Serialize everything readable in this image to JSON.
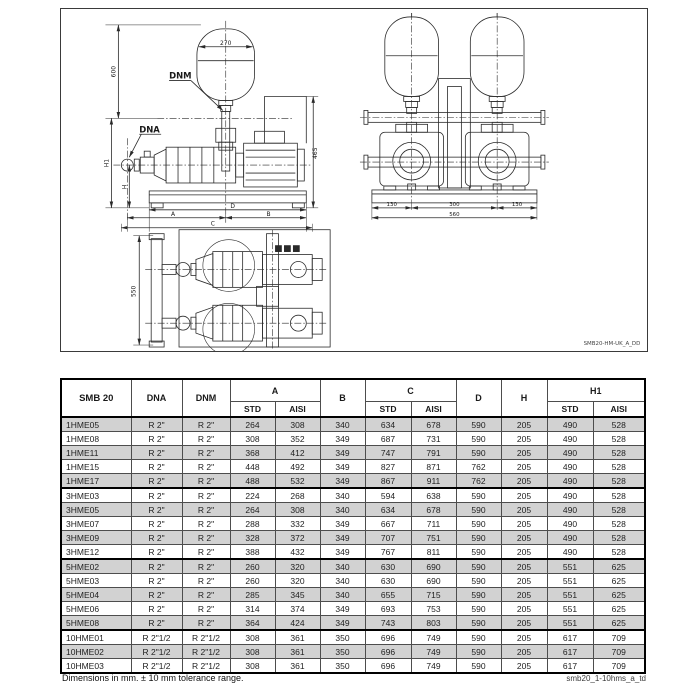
{
  "drawing": {
    "code": "SMB20-HM-UK_A_DD",
    "labels": {
      "tank_diameter": "270",
      "overall_height": "600",
      "dnm": "DNM",
      "dna": "DNA",
      "h1": "H1",
      "h": "H",
      "motor_height": "465",
      "dim_d": "D",
      "dim_a": "A",
      "dim_b": "B",
      "dim_c": "C",
      "front_left": "130",
      "front_mid": "300",
      "front_right": "130",
      "front_total": "560",
      "plan_depth": "550"
    }
  },
  "table": {
    "title": "SMB 20",
    "col_dna": "DNA",
    "col_dnm": "DNM",
    "col_a": "A",
    "col_b": "B",
    "col_c": "C",
    "col_d": "D",
    "col_h": "H",
    "col_h1": "H1",
    "sub_std": "STD",
    "sub_aisi": "AISI",
    "rows": [
      {
        "model": "1HME05",
        "dna": "R 2\"",
        "dnm": "R 2\"",
        "a_std": "264",
        "a_aisi": "308",
        "b": "340",
        "c_std": "634",
        "c_aisi": "678",
        "d": "590",
        "h": "205",
        "h1_std": "490",
        "h1_aisi": "528",
        "group_start": false
      },
      {
        "model": "1HME08",
        "dna": "R 2\"",
        "dnm": "R 2\"",
        "a_std": "308",
        "a_aisi": "352",
        "b": "349",
        "c_std": "687",
        "c_aisi": "731",
        "d": "590",
        "h": "205",
        "h1_std": "490",
        "h1_aisi": "528",
        "group_start": false
      },
      {
        "model": "1HME11",
        "dna": "R 2\"",
        "dnm": "R 2\"",
        "a_std": "368",
        "a_aisi": "412",
        "b": "349",
        "c_std": "747",
        "c_aisi": "791",
        "d": "590",
        "h": "205",
        "h1_std": "490",
        "h1_aisi": "528",
        "group_start": false
      },
      {
        "model": "1HME15",
        "dna": "R 2\"",
        "dnm": "R 2\"",
        "a_std": "448",
        "a_aisi": "492",
        "b": "349",
        "c_std": "827",
        "c_aisi": "871",
        "d": "762",
        "h": "205",
        "h1_std": "490",
        "h1_aisi": "528",
        "group_start": false
      },
      {
        "model": "1HME17",
        "dna": "R 2\"",
        "dnm": "R 2\"",
        "a_std": "488",
        "a_aisi": "532",
        "b": "349",
        "c_std": "867",
        "c_aisi": "911",
        "d": "762",
        "h": "205",
        "h1_std": "490",
        "h1_aisi": "528",
        "group_start": false
      },
      {
        "model": "3HME03",
        "dna": "R 2\"",
        "dnm": "R 2\"",
        "a_std": "224",
        "a_aisi": "268",
        "b": "340",
        "c_std": "594",
        "c_aisi": "638",
        "d": "590",
        "h": "205",
        "h1_std": "490",
        "h1_aisi": "528",
        "group_start": true
      },
      {
        "model": "3HME05",
        "dna": "R 2\"",
        "dnm": "R 2\"",
        "a_std": "264",
        "a_aisi": "308",
        "b": "340",
        "c_std": "634",
        "c_aisi": "678",
        "d": "590",
        "h": "205",
        "h1_std": "490",
        "h1_aisi": "528",
        "group_start": false
      },
      {
        "model": "3HME07",
        "dna": "R 2\"",
        "dnm": "R 2\"",
        "a_std": "288",
        "a_aisi": "332",
        "b": "349",
        "c_std": "667",
        "c_aisi": "711",
        "d": "590",
        "h": "205",
        "h1_std": "490",
        "h1_aisi": "528",
        "group_start": false
      },
      {
        "model": "3HME09",
        "dna": "R 2\"",
        "dnm": "R 2\"",
        "a_std": "328",
        "a_aisi": "372",
        "b": "349",
        "c_std": "707",
        "c_aisi": "751",
        "d": "590",
        "h": "205",
        "h1_std": "490",
        "h1_aisi": "528",
        "group_start": false
      },
      {
        "model": "3HME12",
        "dna": "R 2\"",
        "dnm": "R 2\"",
        "a_std": "388",
        "a_aisi": "432",
        "b": "349",
        "c_std": "767",
        "c_aisi": "811",
        "d": "590",
        "h": "205",
        "h1_std": "490",
        "h1_aisi": "528",
        "group_start": false
      },
      {
        "model": "5HME02",
        "dna": "R 2\"",
        "dnm": "R 2\"",
        "a_std": "260",
        "a_aisi": "320",
        "b": "340",
        "c_std": "630",
        "c_aisi": "690",
        "d": "590",
        "h": "205",
        "h1_std": "551",
        "h1_aisi": "625",
        "group_start": true
      },
      {
        "model": "5HME03",
        "dna": "R 2\"",
        "dnm": "R 2\"",
        "a_std": "260",
        "a_aisi": "320",
        "b": "340",
        "c_std": "630",
        "c_aisi": "690",
        "d": "590",
        "h": "205",
        "h1_std": "551",
        "h1_aisi": "625",
        "group_start": false
      },
      {
        "model": "5HME04",
        "dna": "R 2\"",
        "dnm": "R 2\"",
        "a_std": "285",
        "a_aisi": "345",
        "b": "340",
        "c_std": "655",
        "c_aisi": "715",
        "d": "590",
        "h": "205",
        "h1_std": "551",
        "h1_aisi": "625",
        "group_start": false
      },
      {
        "model": "5HME06",
        "dna": "R 2\"",
        "dnm": "R 2\"",
        "a_std": "314",
        "a_aisi": "374",
        "b": "349",
        "c_std": "693",
        "c_aisi": "753",
        "d": "590",
        "h": "205",
        "h1_std": "551",
        "h1_aisi": "625",
        "group_start": false
      },
      {
        "model": "5HME08",
        "dna": "R 2\"",
        "dnm": "R 2\"",
        "a_std": "364",
        "a_aisi": "424",
        "b": "349",
        "c_std": "743",
        "c_aisi": "803",
        "d": "590",
        "h": "205",
        "h1_std": "551",
        "h1_aisi": "625",
        "group_start": false
      },
      {
        "model": "10HME01",
        "dna": "R 2\"1/2",
        "dnm": "R 2\"1/2",
        "a_std": "308",
        "a_aisi": "361",
        "b": "350",
        "c_std": "696",
        "c_aisi": "749",
        "d": "590",
        "h": "205",
        "h1_std": "617",
        "h1_aisi": "709",
        "group_start": true
      },
      {
        "model": "10HME02",
        "dna": "R 2\"1/2",
        "dnm": "R 2\"1/2",
        "a_std": "308",
        "a_aisi": "361",
        "b": "350",
        "c_std": "696",
        "c_aisi": "749",
        "d": "590",
        "h": "205",
        "h1_std": "617",
        "h1_aisi": "709",
        "group_start": false
      },
      {
        "model": "10HME03",
        "dna": "R 2\"1/2",
        "dnm": "R 2\"1/2",
        "a_std": "308",
        "a_aisi": "361",
        "b": "350",
        "c_std": "696",
        "c_aisi": "749",
        "d": "590",
        "h": "205",
        "h1_std": "617",
        "h1_aisi": "709",
        "group_start": false
      }
    ]
  },
  "footer": {
    "note": "Dimensions in mm. ± 10 mm tolerance range.",
    "doc_code": "smb20_1-10hms_a_td"
  }
}
